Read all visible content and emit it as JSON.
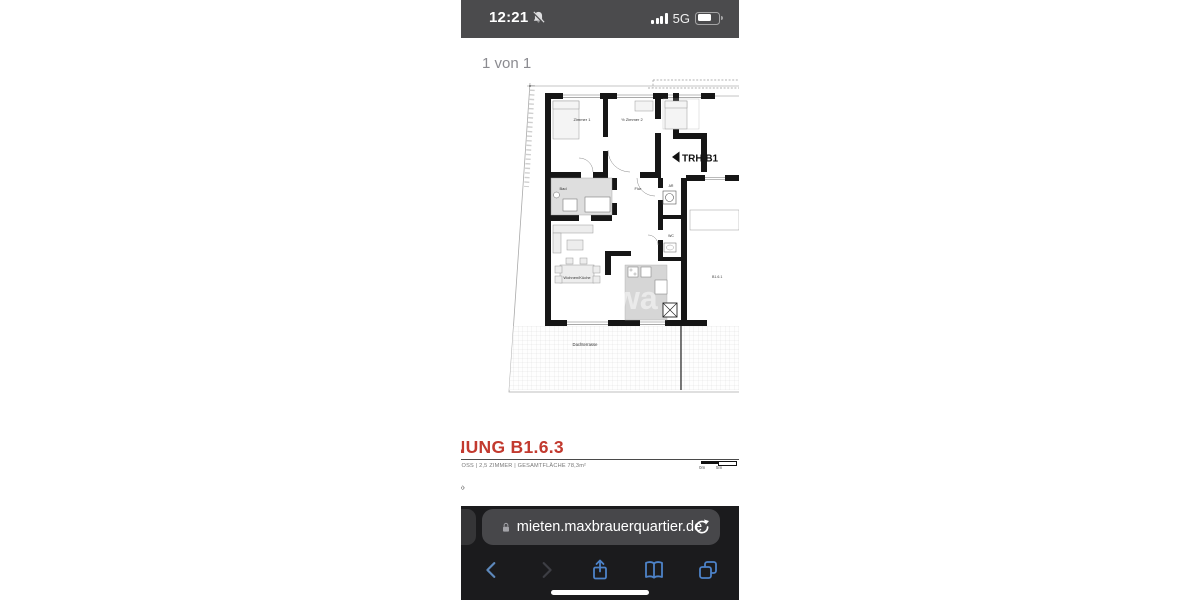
{
  "status_bar": {
    "time": "12:21",
    "mute_icon": "bell-slash",
    "signal_icon": "signal-bars-4",
    "network": "5G",
    "battery_icon": "battery-partial"
  },
  "pdf": {
    "page_indicator": "1 von 1"
  },
  "floor_plan": {
    "rooms": [
      "Zimmer 1",
      "½ Zimmer 2",
      "Bad",
      "Flur",
      "AR",
      "WC",
      "Wohnen/Küche",
      "Dachterrasse"
    ],
    "stairwell_label": "TRH B1",
    "unit_label": "B1.6.1",
    "watermark": "wa"
  },
  "listing": {
    "title": "WOHNUNG B1.6.3",
    "details": "DACHGESCHOSS | 2,5 ZIMMER | GESAMTFLÄCHE 78,3m²",
    "scale_bar_labels": [
      "0m",
      "5m"
    ],
    "overflow_glyph": "»",
    "accent_color": "#c23a2f"
  },
  "browser": {
    "url": "mieten.maxbrauerquartier.de",
    "lock_icon": "lock",
    "reload_icon": "reload",
    "toolbar_icons": [
      "back",
      "forward",
      "share",
      "bookmarks",
      "tabs"
    ]
  }
}
